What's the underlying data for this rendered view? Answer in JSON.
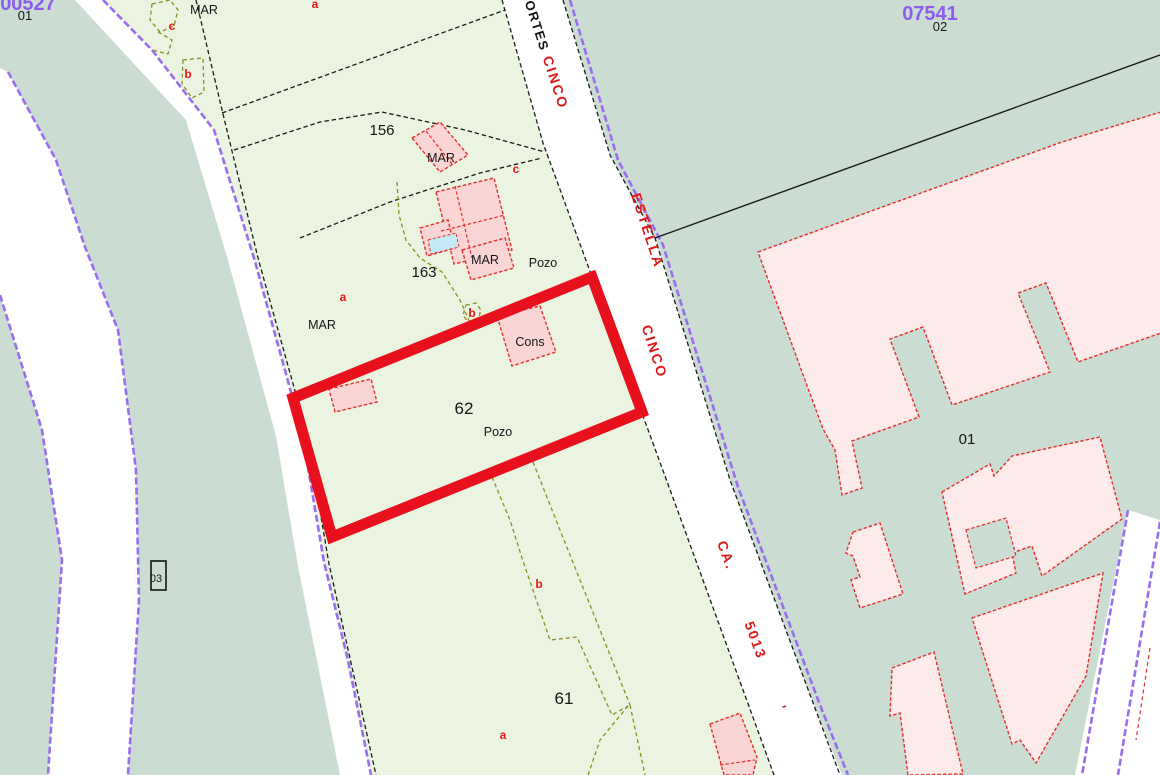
{
  "map": {
    "type": "cadastral-parcel-map",
    "highlighted_parcel": "62",
    "colors": {
      "parcel-green": "#eaf4e1",
      "area-gray": "#cbdcd2",
      "road-white": "#ffffff",
      "purple-line": "#9a6ef0",
      "purple-code": "#8f5cf0",
      "line-black": "#1b1b1b",
      "olive": "#8d8d20",
      "building-fill-light": "#fdeaea",
      "building-fill": "#f9d5d5",
      "building-stroke": "#e23030",
      "highlight-red": "#e8101c",
      "pool-cyan": "#c4e9f4",
      "boundary-blue": "#2233dd",
      "red-text": "#e01818"
    },
    "labels": [
      {
        "t": "00527",
        "x": 28,
        "y": 10,
        "c": "code",
        "n": "sheet-code-00527"
      },
      {
        "t": "01",
        "x": 25,
        "y": 20,
        "c": "num-s",
        "n": "block-01-topleft"
      },
      {
        "t": "07541",
        "x": 930,
        "y": 20,
        "c": "code",
        "n": "sheet-code-07541"
      },
      {
        "t": "02",
        "x": 940,
        "y": 31,
        "c": "num-s",
        "n": "block-02"
      },
      {
        "t": "MAR",
        "x": 204,
        "y": 14,
        "c": "name",
        "n": "label-mar-top"
      },
      {
        "t": "a",
        "x": 315,
        "y": 8,
        "c": "red",
        "n": "subparcel-a-top"
      },
      {
        "t": "c",
        "x": 172,
        "y": 30,
        "c": "red",
        "n": "subparcel-c-top"
      },
      {
        "t": "b",
        "x": 188,
        "y": 78,
        "c": "red",
        "n": "subparcel-b-top"
      },
      {
        "t": "CORTES",
        "x": 531,
        "y": 22,
        "r": 72,
        "c": "st-black",
        "n": "street-cortes"
      },
      {
        "t": "CINCO",
        "x": 551,
        "y": 84,
        "r": 72,
        "c": "st-red",
        "n": "street-cinco-top"
      },
      {
        "t": "156",
        "x": 382,
        "y": 135,
        "c": "num",
        "n": "parcel-156"
      },
      {
        "t": "MAR",
        "x": 441,
        "y": 162,
        "c": "name",
        "n": "label-mar-156"
      },
      {
        "t": "c",
        "x": 516,
        "y": 173,
        "c": "red",
        "n": "subparcel-c-163"
      },
      {
        "t": "163",
        "x": 424,
        "y": 277,
        "c": "num",
        "n": "parcel-163"
      },
      {
        "t": "MAR",
        "x": 485,
        "y": 264,
        "c": "name",
        "n": "label-mar-163"
      },
      {
        "t": "Pozo",
        "x": 543,
        "y": 267,
        "c": "name",
        "n": "label-pozo-163"
      },
      {
        "t": "ESTELLA",
        "x": 643,
        "y": 232,
        "r": 72,
        "c": "st-red",
        "n": "street-estella"
      },
      {
        "t": "a",
        "x": 343,
        "y": 301,
        "c": "red",
        "n": "subparcel-a-163"
      },
      {
        "t": "MAR",
        "x": 322,
        "y": 329,
        "c": "name",
        "n": "label-mar-a"
      },
      {
        "t": "b",
        "x": 472,
        "y": 317,
        "c": "red",
        "n": "subparcel-b-163"
      },
      {
        "t": "Cons",
        "x": 530,
        "y": 346,
        "c": "name",
        "n": "label-cons"
      },
      {
        "t": "CINCO",
        "x": 650,
        "y": 353,
        "r": 72,
        "c": "st-red",
        "n": "street-cinco-mid"
      },
      {
        "t": "62",
        "x": 464,
        "y": 414,
        "c": "num-l",
        "n": "parcel-62"
      },
      {
        "t": "Pozo",
        "x": 498,
        "y": 436,
        "c": "name",
        "n": "label-pozo-62"
      },
      {
        "t": "01",
        "x": 967,
        "y": 444,
        "c": "num",
        "n": "block-01-right"
      },
      {
        "t": "CA.",
        "x": 722,
        "y": 557,
        "r": 70,
        "c": "st-red",
        "n": "street-ca"
      },
      {
        "t": "5013",
        "x": 751,
        "y": 642,
        "r": 70,
        "c": "st-red",
        "n": "street-5013"
      },
      {
        "t": "'",
        "x": 777,
        "y": 710,
        "r": 72,
        "c": "st-red",
        "n": "street-tick"
      },
      {
        "t": "03",
        "x": 156,
        "y": 582,
        "c": "num-xs",
        "n": "block-03"
      },
      {
        "t": "b",
        "x": 539,
        "y": 588,
        "c": "red",
        "n": "subparcel-b-61"
      },
      {
        "t": "61",
        "x": 564,
        "y": 704,
        "c": "num-l",
        "n": "parcel-61"
      },
      {
        "t": "a",
        "x": 503,
        "y": 739,
        "c": "red",
        "n": "subparcel-a-61"
      }
    ]
  }
}
